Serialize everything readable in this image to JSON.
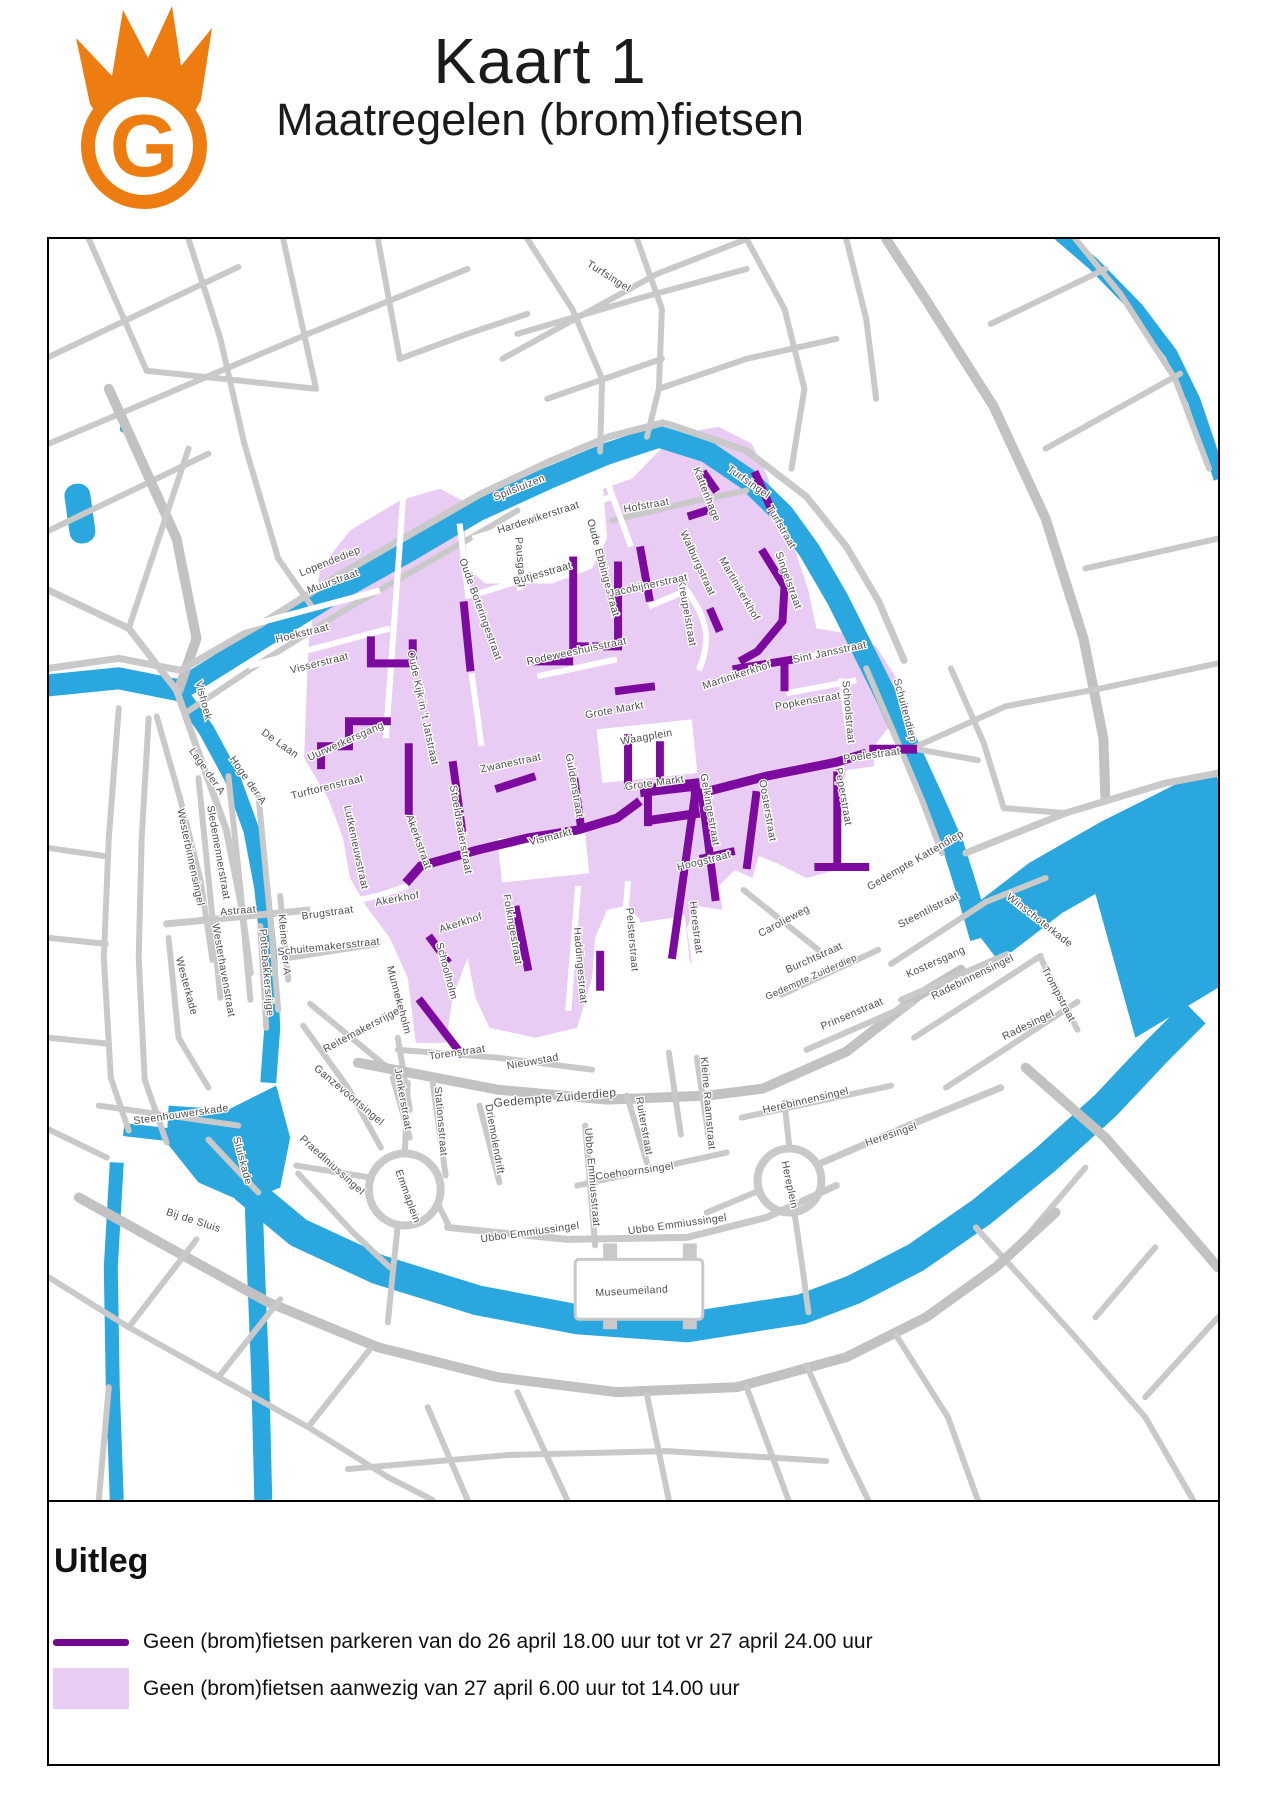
{
  "header": {
    "title": "Kaart 1",
    "subtitle": "Maatregelen (brom)fietsen",
    "logo_letter": "G"
  },
  "legend": {
    "heading": "Uitleg",
    "items": [
      {
        "swatch": "line",
        "label": "Geen (brom)fietsen parkeren van do 26 april 18.00 uur tot vr 27 april 24.00 uur"
      },
      {
        "swatch": "area",
        "label": "Geen (brom)fietsen aanwezig van 27 april 6.00 uur tot 14.00 uur"
      }
    ]
  },
  "colors": {
    "water": "#29A7DE",
    "zone": "#E9CCF3",
    "restricted_street": "#7D0A9E",
    "legend_line": "#71088F",
    "road": "#C9C9C9",
    "road_major": "#C2C2C2",
    "street_label": "#4D4D4D",
    "logo_orange": "#EE7D11"
  },
  "map": {
    "street_labels": [
      {
        "t": "Spilsluizen",
        "x": 473,
        "y": 252,
        "r": -22
      },
      {
        "t": "Lopendediep",
        "x": 283,
        "y": 326,
        "r": -22
      },
      {
        "t": "Turfsingel",
        "x": 560,
        "y": 40,
        "r": 32
      },
      {
        "t": "Turfsingel",
        "x": 700,
        "y": 246,
        "r": 35
      },
      {
        "t": "Hofstraat",
        "x": 600,
        "y": 270,
        "r": -10
      },
      {
        "t": "Hardewikerstraat",
        "x": 492,
        "y": 282,
        "r": -18
      },
      {
        "t": "Pausgang",
        "x": 470,
        "y": 324,
        "r": 85
      },
      {
        "t": "Butjesstraat",
        "x": 496,
        "y": 338,
        "r": -16
      },
      {
        "t": "Oude Ebbingestraat",
        "x": 553,
        "y": 330,
        "r": 75
      },
      {
        "t": "Oude Boteringestraat",
        "x": 430,
        "y": 372,
        "r": 70
      },
      {
        "t": "Muurstraat",
        "x": 286,
        "y": 346,
        "r": -20
      },
      {
        "t": "Hoekstraat",
        "x": 255,
        "y": 398,
        "r": -14
      },
      {
        "t": "Visserstraat",
        "x": 272,
        "y": 428,
        "r": -14
      },
      {
        "t": "Vishoek",
        "x": 152,
        "y": 463,
        "r": 75
      },
      {
        "t": "De Laan",
        "x": 230,
        "y": 508,
        "r": 35
      },
      {
        "t": "Uurwerkersgang",
        "x": 299,
        "y": 506,
        "r": -24
      },
      {
        "t": "Oude Kijk in 't Jatstraat",
        "x": 372,
        "y": 470,
        "r": 78
      },
      {
        "t": "Turftorenstraat",
        "x": 280,
        "y": 552,
        "r": -14
      },
      {
        "t": "Lutkenieuwstraat",
        "x": 305,
        "y": 610,
        "r": 78
      },
      {
        "t": "Zwanestraat",
        "x": 464,
        "y": 528,
        "r": -12
      },
      {
        "t": "Stoeldraaierstraat",
        "x": 410,
        "y": 592,
        "r": 80
      },
      {
        "t": "Guldenstraat",
        "x": 524,
        "y": 548,
        "r": 80
      },
      {
        "t": "Grote Markt",
        "x": 568,
        "y": 475,
        "r": -10
      },
      {
        "t": "Grote Markt",
        "x": 608,
        "y": 548,
        "r": -8
      },
      {
        "t": "Waagplein",
        "x": 600,
        "y": 502,
        "r": -10
      },
      {
        "t": "Vismarkt",
        "x": 504,
        "y": 602,
        "r": -14
      },
      {
        "t": "Akerkhof",
        "x": 350,
        "y": 664,
        "r": -10
      },
      {
        "t": "Akerkhof",
        "x": 414,
        "y": 688,
        "r": -18
      },
      {
        "t": "Akerkstraat",
        "x": 368,
        "y": 605,
        "r": 70
      },
      {
        "t": "Brugstraat",
        "x": 280,
        "y": 678,
        "r": -8
      },
      {
        "t": "Folkingestraat",
        "x": 462,
        "y": 692,
        "r": 80
      },
      {
        "t": "Schoolholm",
        "x": 396,
        "y": 734,
        "r": 75
      },
      {
        "t": "Haddingestraat",
        "x": 530,
        "y": 728,
        "r": 85
      },
      {
        "t": "Pelsterstraat",
        "x": 582,
        "y": 702,
        "r": 85
      },
      {
        "t": "Gelkingestraat",
        "x": 660,
        "y": 572,
        "r": 80
      },
      {
        "t": "Hoogstraat",
        "x": 658,
        "y": 626,
        "r": -14
      },
      {
        "t": "Herestraat",
        "x": 646,
        "y": 690,
        "r": 83
      },
      {
        "t": "Oosterstraat",
        "x": 718,
        "y": 573,
        "r": 80
      },
      {
        "t": "Peperstraat",
        "x": 794,
        "y": 559,
        "r": 80
      },
      {
        "t": "Poelestraat",
        "x": 826,
        "y": 520,
        "r": -8
      },
      {
        "t": "Sint Jansstraat",
        "x": 784,
        "y": 417,
        "r": -12
      },
      {
        "t": "Schoolstraat",
        "x": 799,
        "y": 474,
        "r": 85
      },
      {
        "t": "Popkenstraat",
        "x": 762,
        "y": 466,
        "r": -10
      },
      {
        "t": "Martinikerkhof",
        "x": 691,
        "y": 440,
        "r": -18
      },
      {
        "t": "Martinikerkhof",
        "x": 690,
        "y": 352,
        "r": 60
      },
      {
        "t": "Kreupelstraat",
        "x": 637,
        "y": 375,
        "r": 80
      },
      {
        "t": "Walburgstraat",
        "x": 648,
        "y": 326,
        "r": 65
      },
      {
        "t": "Kattenhage",
        "x": 657,
        "y": 257,
        "r": 68
      },
      {
        "t": "Jacobijnerstraat",
        "x": 602,
        "y": 350,
        "r": -12
      },
      {
        "t": "Rodeweeshuisstraat",
        "x": 530,
        "y": 416,
        "r": -12
      },
      {
        "t": "Turfstraat",
        "x": 732,
        "y": 290,
        "r": 60
      },
      {
        "t": "Singelstraat",
        "x": 739,
        "y": 343,
        "r": 70
      },
      {
        "t": "Schuitendiep",
        "x": 856,
        "y": 473,
        "r": 75
      },
      {
        "t": "Winschoterkade",
        "x": 992,
        "y": 685,
        "r": 38
      },
      {
        "t": "Steentilstraat",
        "x": 884,
        "y": 675,
        "r": -27
      },
      {
        "t": "Gedempte Kattendiep",
        "x": 871,
        "y": 625,
        "r": -30
      },
      {
        "t": "Carolieweg",
        "x": 739,
        "y": 686,
        "r": -28
      },
      {
        "t": "Burchtstraat",
        "x": 769,
        "y": 723,
        "r": -24
      },
      {
        "t": "Gedempte Zuiderdiep",
        "x": 766,
        "y": 742,
        "r": -24,
        "s": 9.5
      },
      {
        "t": "Gedempte Zuiderdiep",
        "x": 508,
        "y": 864,
        "r": -5,
        "s": 12
      },
      {
        "t": "Kostersgang",
        "x": 891,
        "y": 727,
        "r": -24
      },
      {
        "t": "Radebinnensingel",
        "x": 928,
        "y": 742,
        "r": -26
      },
      {
        "t": "Radesingel",
        "x": 984,
        "y": 790,
        "r": -26
      },
      {
        "t": "Trompstraat",
        "x": 1010,
        "y": 758,
        "r": 62
      },
      {
        "t": "Prinsenstraat",
        "x": 807,
        "y": 779,
        "r": -23
      },
      {
        "t": "Herebinnensingel",
        "x": 760,
        "y": 866,
        "r": -13
      },
      {
        "t": "Heresingel",
        "x": 846,
        "y": 900,
        "r": -19
      },
      {
        "t": "Hereplein",
        "x": 740,
        "y": 948,
        "r": 78
      },
      {
        "t": "Kleine Raamstraat",
        "x": 658,
        "y": 866,
        "r": 85
      },
      {
        "t": "Astraat",
        "x": 190,
        "y": 676,
        "r": -5
      },
      {
        "t": "Westerhavenstraat",
        "x": 172,
        "y": 733,
        "r": 80
      },
      {
        "t": "Westerbinnensingel",
        "x": 139,
        "y": 620,
        "r": 78
      },
      {
        "t": "Sledemennerstraat",
        "x": 167,
        "y": 615,
        "r": 80
      },
      {
        "t": "Lage der A",
        "x": 156,
        "y": 535,
        "r": 55
      },
      {
        "t": "Hoge der A",
        "x": 197,
        "y": 544,
        "r": 55
      },
      {
        "t": "Westerkade",
        "x": 135,
        "y": 749,
        "r": 75
      },
      {
        "t": "Pottebakkersrijge",
        "x": 215,
        "y": 735,
        "r": 85
      },
      {
        "t": "Kleine der A",
        "x": 233,
        "y": 707,
        "r": 85
      },
      {
        "t": "Schuitemakersstraat",
        "x": 281,
        "y": 712,
        "r": -6
      },
      {
        "t": "Munnekeholm",
        "x": 348,
        "y": 763,
        "r": 75
      },
      {
        "t": "Reitemakersrijge",
        "x": 315,
        "y": 795,
        "r": -28
      },
      {
        "t": "Torenstraat",
        "x": 410,
        "y": 818,
        "r": -8
      },
      {
        "t": "Nieuwstad",
        "x": 486,
        "y": 827,
        "r": -10
      },
      {
        "t": "Ganzevoortsingel",
        "x": 299,
        "y": 860,
        "r": 40
      },
      {
        "t": "Steenhouwerskade",
        "x": 133,
        "y": 880,
        "r": -8
      },
      {
        "t": "Sluiskade",
        "x": 191,
        "y": 924,
        "r": 75
      },
      {
        "t": "Bij de Sluis",
        "x": 144,
        "y": 986,
        "r": 18
      },
      {
        "t": "Praediniussingel",
        "x": 282,
        "y": 930,
        "r": 42
      },
      {
        "t": "Emmaplein",
        "x": 357,
        "y": 960,
        "r": 70
      },
      {
        "t": "Stationsstraat",
        "x": 390,
        "y": 884,
        "r": 85
      },
      {
        "t": "Jonkerstraat",
        "x": 352,
        "y": 862,
        "r": 80
      },
      {
        "t": "Driemolendrift",
        "x": 444,
        "y": 902,
        "r": 80
      },
      {
        "t": "Ubbo Emmiussingel",
        "x": 483,
        "y": 998,
        "r": -8
      },
      {
        "t": "Ubbo Emmiussingel",
        "x": 631,
        "y": 990,
        "r": -8
      },
      {
        "t": "Ubbo Emmiusstraat",
        "x": 542,
        "y": 940,
        "r": 85
      },
      {
        "t": "Coehoornsingel",
        "x": 588,
        "y": 937,
        "r": -8
      },
      {
        "t": "Ruiterstraat",
        "x": 594,
        "y": 889,
        "r": 80
      },
      {
        "t": "Museumeiland",
        "x": 585,
        "y": 1057,
        "r": -3
      }
    ]
  }
}
